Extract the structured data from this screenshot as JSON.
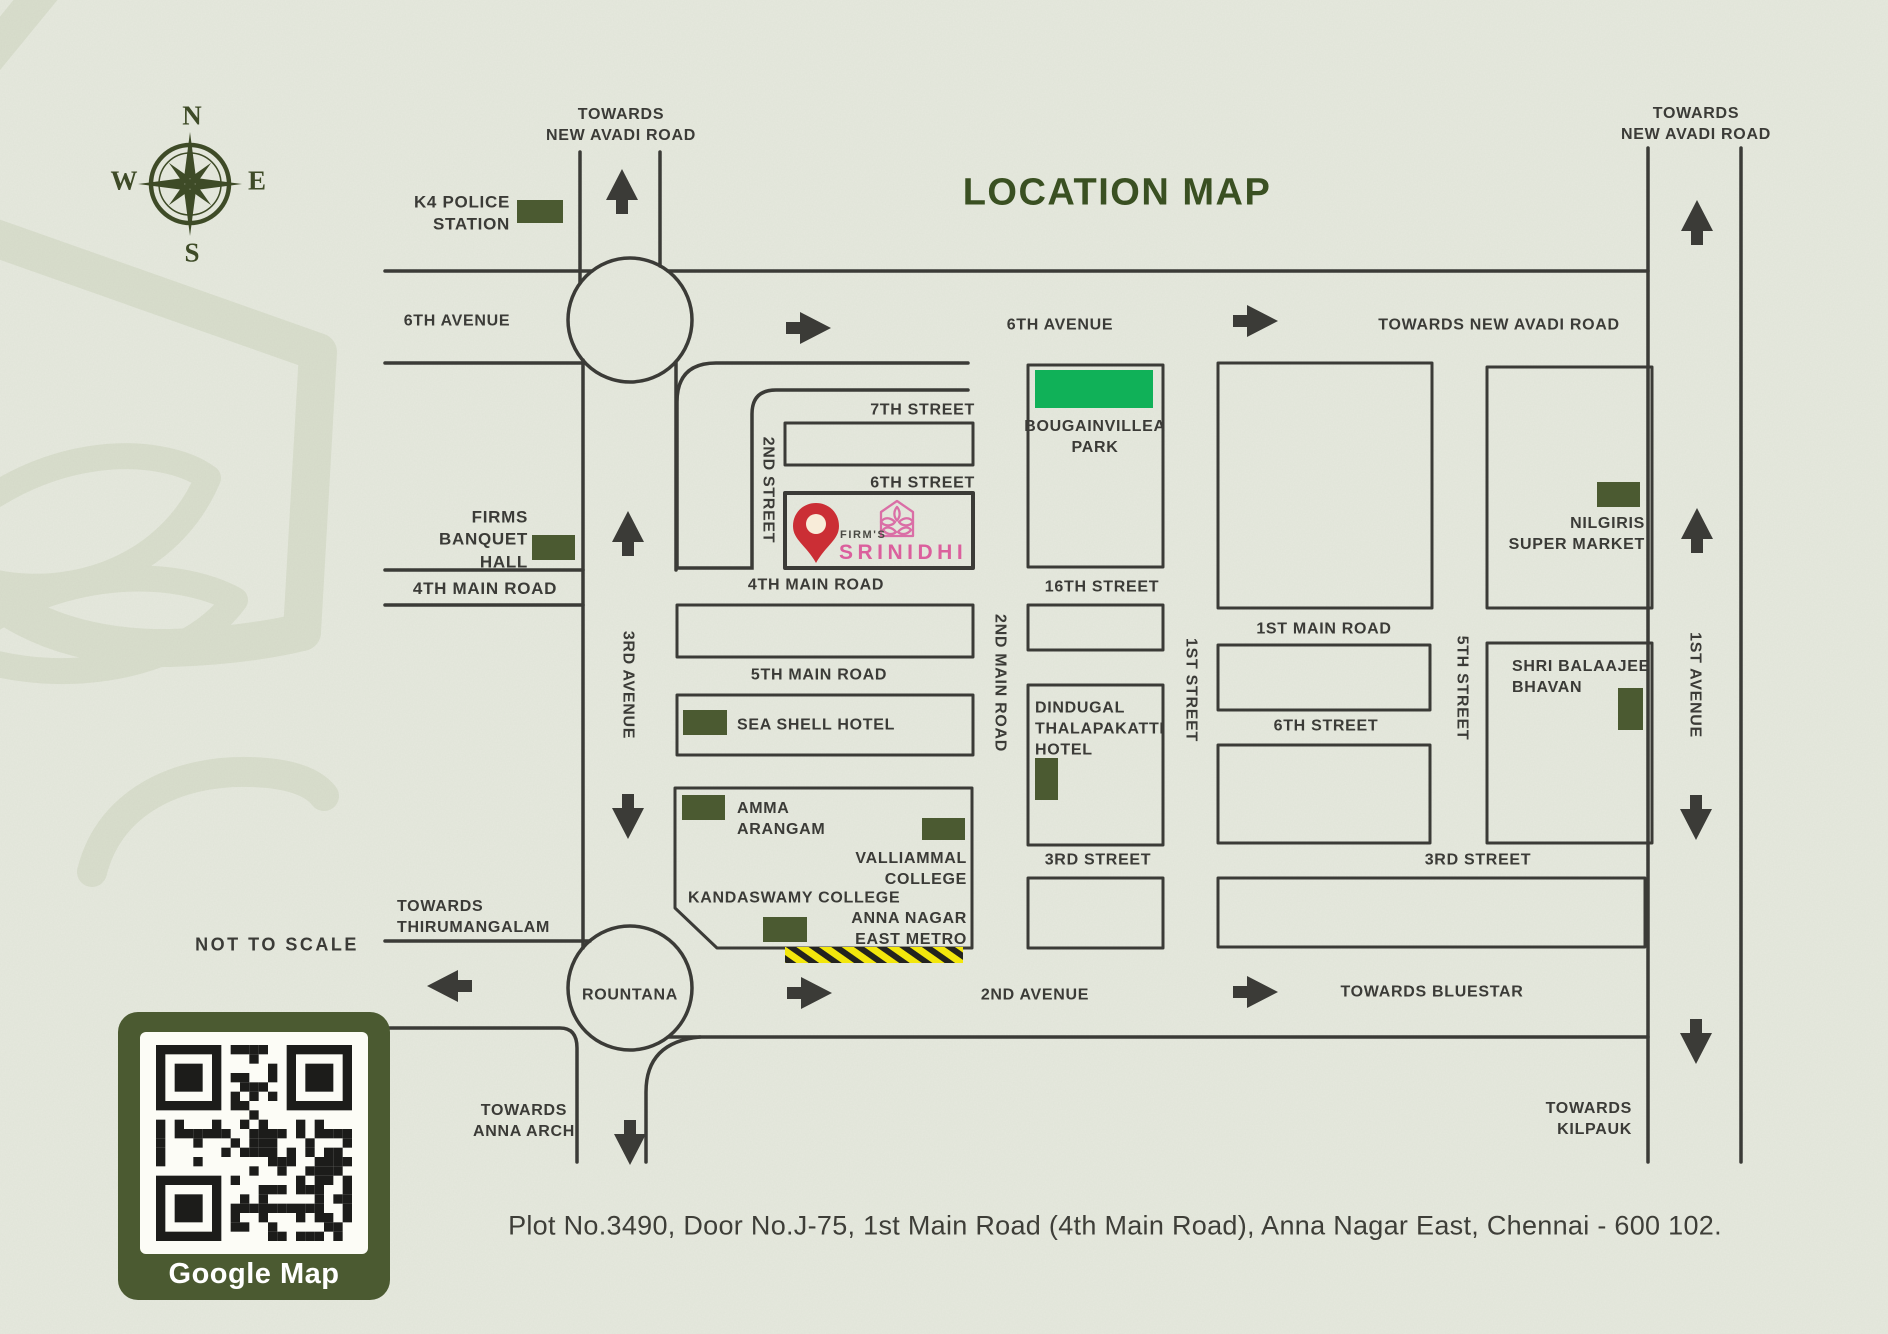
{
  "header": {
    "title": "LOCATION MAP",
    "scale_note": "NOT TO SCALE"
  },
  "compass": {
    "north": "N",
    "east": "E",
    "south": "S",
    "west": "W"
  },
  "marker": {
    "brand_prefix": "FIRM'S",
    "brand_name": "SRINIDHI"
  },
  "qr": {
    "caption": "Google Map"
  },
  "footer": {
    "address": "Plot No.3490, Door No.J-75, 1st Main Road (4th Main Road), Anna Nagar East, Chennai - 600 102."
  },
  "colors": {
    "background": "#e6e9de",
    "road": "#3b3b37",
    "landmark_green": "#4b5a31",
    "park_green": "#10b158",
    "title_green": "#3a5022",
    "brand_pink": "#db5f9d",
    "pin_red": "#cb2e35",
    "metro_yellow": "#f3e70c",
    "watermark": "#d9decd"
  },
  "labels": {
    "towards_new_avadi_top": "TOWARDS\nNEW AVADI ROAD",
    "towards_new_avadi_top_right": "TOWARDS\nNEW AVADI ROAD",
    "towards_new_avadi_east": "TOWARDS NEW AVADI ROAD",
    "k4_police_station": "K4 POLICE\nSTATION",
    "sixth_avenue_west": "6TH AVENUE",
    "sixth_avenue_center": "6TH AVENUE",
    "seventh_street": "7TH STREET",
    "sixth_street_a": "6TH STREET",
    "second_street": "2ND STREET",
    "firms_banquet_hall": "FIRMS\nBANQUET\nHALL",
    "fourth_main_road_west": "4TH MAIN ROAD",
    "fourth_main_road_center": "4TH MAIN ROAD",
    "bougainvillea_park": "BOUGAINVILLEA\nPARK",
    "sixteenth_street": "16TH STREET",
    "second_main_road": "2ND MAIN ROAD",
    "first_street": "1ST STREET",
    "first_main_road": "1ST MAIN ROAD",
    "fifth_street": "5TH STREET",
    "nilgiris_super_market": "NILGIRIS\nSUPER MARKET",
    "fifth_main_road": "5TH MAIN ROAD",
    "sea_shell_hotel": "SEA SHELL HOTEL",
    "dindugal_thalapakatti_hotel": "DINDUGAL\nTHALAPAKATTI\nHOTEL",
    "sixth_street_b": "6TH STREET",
    "shri_balaajee_bhavan": "SHRI BALAAJEE\nBHAVAN",
    "first_avenue": "1ST AVENUE",
    "third_avenue": "3RD AVENUE",
    "amma_arangam": "AMMA\nARANGAM",
    "valliammal_college": "VALLIAMMAL\nCOLLEGE",
    "kandaswamy_college": "KANDASWAMY COLLEGE",
    "anna_nagar_east_metro": "ANNA NAGAR\nEAST METRO",
    "third_street_west": "3RD STREET",
    "third_street_east": "3RD STREET",
    "towards_thirumangalam": "TOWARDS\nTHIRUMANGALAM",
    "rountana": "ROUNTANA",
    "second_avenue": "2ND AVENUE",
    "towards_bluestar": "TOWARDS BLUESTAR",
    "towards_anna_arch": "TOWARDS\nANNA ARCH",
    "towards_kilpauk": "TOWARDS\nKILPAUK"
  }
}
